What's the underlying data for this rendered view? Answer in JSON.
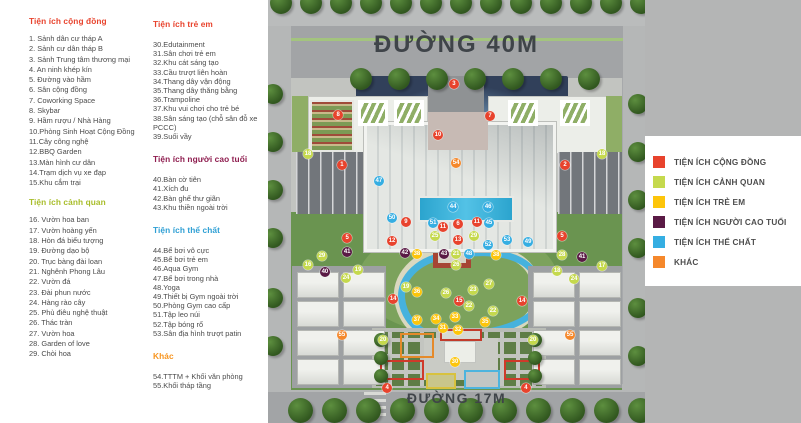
{
  "amenities": {
    "congdong": {
      "title": "Tiện ích cộng đồng",
      "color": "#e8432d",
      "items": [
        "1. Sảnh dân cư tháp A",
        "2. Sảnh cư dân tháp B",
        "3. Sảnh Trung tâm thương mại",
        "4. An ninh khép kín",
        "5. Đường vào hầm",
        "6. Sân cộng đồng",
        "7. Coworking Space",
        "8. Skybar",
        "9. Hầm rượu / Nhà Hàng",
        "10.Phòng Sinh Hoạt Cộng Đồng",
        "11.Cây công nghệ",
        "12.BBQ Garden",
        "13.Màn hình cư dân",
        "14.Trạm dịch vụ xe đạp",
        "15.Khu cắm trại"
      ]
    },
    "canhquan": {
      "title": "Tiện ích cảnh quan",
      "color": "#a8bd2a",
      "items": [
        "16. Vườn hoa ban",
        "17. Vườn hoàng yến",
        "18. Hòn đá biểu tượng",
        "19. Đường dạo bộ",
        "20. Trục bàng đài loan",
        "21. Nghênh Phong Lâu",
        "22. Vườn đá",
        "23. Đài phun nước",
        "24. Hàng rào cây",
        "25. Phù điêu nghệ thuật",
        "26. Thác tràn",
        "27. Vườn hoa",
        "28. Garden of love",
        "29. Chòi hoa"
      ]
    },
    "treem": {
      "title": "Tiện ích trẻ em",
      "color": "#e8432d",
      "items": [
        "30.Edutainment",
        "31.Sân chơi trẻ em",
        "32.Khu cát sáng tạo",
        "33.Cầu trượt liên hoàn",
        "34.Thang dây vận động",
        "35.Thang dây thăng bằng",
        "36.Trampoline",
        "37.Khu vui chơi cho trẻ bé",
        "38.Sân sáng tạo (chỗ sân đỗ xe PCCC)",
        "39.Suối vầy"
      ]
    },
    "caotuoi": {
      "title": "Tiện ích người cao tuổi",
      "color": "#8e1c4e",
      "items": [
        "40.Bàn cờ tiên",
        "41.Xích đu",
        "42.Bàn ghế thư giãn",
        "43.Khu thiền ngoài trời"
      ]
    },
    "thechat": {
      "title": "Tiện ích thể chất",
      "color": "#2e9fd4",
      "items": [
        "44.Bể bơi vô cực",
        "45.Bể bơi trẻ em",
        "46.Aqua Gym",
        "47.Bể bơi trong nhà",
        "48.Yoga",
        "49.Thiết bị Gym ngoài trời",
        "50.Phòng Gym cao cấp",
        "51.Tập leo núi",
        "52.Tập bóng rổ",
        "53.Sân địa hình trượt patin"
      ]
    },
    "khac": {
      "title": "Khác",
      "color": "#f7941e",
      "items": [
        "54.TTTM + Khối văn phòng",
        "55.Khối tháp tầng"
      ]
    }
  },
  "map": {
    "road_top_label": "ĐƯỜNG 40M",
    "road_bottom_label": "ĐƯỜNG 17M",
    "markers": [
      {
        "n": 3,
        "cat": "congdong",
        "x": 49.3,
        "y": 19.9
      },
      {
        "n": 8,
        "cat": "congdong",
        "x": 18.6,
        "y": 27.2
      },
      {
        "n": 7,
        "cat": "congdong",
        "x": 58.9,
        "y": 27.4
      },
      {
        "n": 10,
        "cat": "congdong",
        "x": 45.1,
        "y": 31.9
      },
      {
        "n": 54,
        "cat": "khac",
        "x": 49.9,
        "y": 38.5
      },
      {
        "n": 1,
        "cat": "congdong",
        "x": 19.6,
        "y": 39.0
      },
      {
        "n": 2,
        "cat": "congdong",
        "x": 78.8,
        "y": 39.0
      },
      {
        "n": 18,
        "cat": "canhquan",
        "x": 10.6,
        "y": 36.4
      },
      {
        "n": 18,
        "cat": "canhquan",
        "x": 88.6,
        "y": 36.4
      },
      {
        "n": 47,
        "cat": "thechat",
        "x": 29.4,
        "y": 42.8
      },
      {
        "n": 44,
        "cat": "thechat",
        "x": 49.1,
        "y": 48.9
      },
      {
        "n": 46,
        "cat": "thechat",
        "x": 58.4,
        "y": 48.9
      },
      {
        "n": 50,
        "cat": "thechat",
        "x": 32.9,
        "y": 51.5
      },
      {
        "n": 9,
        "cat": "congdong",
        "x": 36.6,
        "y": 52.5
      },
      {
        "n": 51,
        "cat": "thechat",
        "x": 43.8,
        "y": 52.7
      },
      {
        "n": 11,
        "cat": "congdong",
        "x": 46.4,
        "y": 53.7
      },
      {
        "n": 6,
        "cat": "congdong",
        "x": 50.4,
        "y": 53.0
      },
      {
        "n": 11,
        "cat": "congdong",
        "x": 55.4,
        "y": 52.5
      },
      {
        "n": 45,
        "cat": "thechat",
        "x": 58.6,
        "y": 52.7
      },
      {
        "n": 5,
        "cat": "congdong",
        "x": 21.0,
        "y": 56.3
      },
      {
        "n": 25,
        "cat": "canhquan",
        "x": 44.3,
        "y": 55.8
      },
      {
        "n": 13,
        "cat": "congdong",
        "x": 50.4,
        "y": 56.7
      },
      {
        "n": 29,
        "cat": "canhquan",
        "x": 54.6,
        "y": 55.8
      },
      {
        "n": 52,
        "cat": "thechat",
        "x": 58.4,
        "y": 57.9
      },
      {
        "n": 53,
        "cat": "thechat",
        "x": 63.4,
        "y": 56.7
      },
      {
        "n": 49,
        "cat": "thechat",
        "x": 69.0,
        "y": 57.2
      },
      {
        "n": 5,
        "cat": "congdong",
        "x": 78.0,
        "y": 55.8
      },
      {
        "n": 41,
        "cat": "caotuoi",
        "x": 21.0,
        "y": 59.6
      },
      {
        "n": 12,
        "cat": "congdong",
        "x": 32.9,
        "y": 57.0
      },
      {
        "n": 42,
        "cat": "caotuoi",
        "x": 36.3,
        "y": 59.8
      },
      {
        "n": 38,
        "cat": "treem",
        "x": 39.5,
        "y": 60.0
      },
      {
        "n": 43,
        "cat": "caotuoi",
        "x": 46.7,
        "y": 60.0
      },
      {
        "n": 21,
        "cat": "canhquan",
        "x": 49.9,
        "y": 60.0
      },
      {
        "n": 48,
        "cat": "thechat",
        "x": 53.3,
        "y": 60.0
      },
      {
        "n": 38,
        "cat": "treem",
        "x": 60.5,
        "y": 60.3
      },
      {
        "n": 28,
        "cat": "canhquan",
        "x": 78.0,
        "y": 60.3
      },
      {
        "n": 41,
        "cat": "caotuoi",
        "x": 83.3,
        "y": 60.8
      },
      {
        "n": 29,
        "cat": "canhquan",
        "x": 14.3,
        "y": 60.5
      },
      {
        "n": 16,
        "cat": "canhquan",
        "x": 10.6,
        "y": 62.6
      },
      {
        "n": 17,
        "cat": "canhquan",
        "x": 88.6,
        "y": 62.9
      },
      {
        "n": 40,
        "cat": "caotuoi",
        "x": 15.1,
        "y": 64.3
      },
      {
        "n": 19,
        "cat": "canhquan",
        "x": 23.9,
        "y": 63.8
      },
      {
        "n": 24,
        "cat": "canhquan",
        "x": 20.7,
        "y": 65.7
      },
      {
        "n": 18,
        "cat": "canhquan",
        "x": 76.7,
        "y": 64.1
      },
      {
        "n": 24,
        "cat": "canhquan",
        "x": 81.2,
        "y": 66.0
      },
      {
        "n": 26,
        "cat": "canhquan",
        "x": 49.9,
        "y": 62.6
      },
      {
        "n": 27,
        "cat": "canhquan",
        "x": 58.6,
        "y": 67.1
      },
      {
        "n": 23,
        "cat": "canhquan",
        "x": 54.4,
        "y": 68.6
      },
      {
        "n": 19,
        "cat": "canhquan",
        "x": 36.6,
        "y": 67.8
      },
      {
        "n": 36,
        "cat": "treem",
        "x": 39.5,
        "y": 69.0
      },
      {
        "n": 26,
        "cat": "canhquan",
        "x": 47.2,
        "y": 69.3
      },
      {
        "n": 14,
        "cat": "congdong",
        "x": 33.2,
        "y": 70.7
      },
      {
        "n": 15,
        "cat": "congdong",
        "x": 50.7,
        "y": 71.2
      },
      {
        "n": 22,
        "cat": "canhquan",
        "x": 53.3,
        "y": 72.3
      },
      {
        "n": 14,
        "cat": "congdong",
        "x": 67.4,
        "y": 71.2
      },
      {
        "n": 22,
        "cat": "canhquan",
        "x": 59.7,
        "y": 73.5
      },
      {
        "n": 37,
        "cat": "treem",
        "x": 39.5,
        "y": 75.7
      },
      {
        "n": 34,
        "cat": "treem",
        "x": 44.6,
        "y": 75.4
      },
      {
        "n": 33,
        "cat": "treem",
        "x": 49.6,
        "y": 74.9
      },
      {
        "n": 35,
        "cat": "treem",
        "x": 57.6,
        "y": 76.1
      },
      {
        "n": 31,
        "cat": "treem",
        "x": 46.4,
        "y": 77.5
      },
      {
        "n": 32,
        "cat": "treem",
        "x": 50.4,
        "y": 78.0
      },
      {
        "n": 55,
        "cat": "khac",
        "x": 19.6,
        "y": 79.2
      },
      {
        "n": 55,
        "cat": "khac",
        "x": 80.1,
        "y": 79.2
      },
      {
        "n": 20,
        "cat": "canhquan",
        "x": 30.5,
        "y": 80.4
      },
      {
        "n": 20,
        "cat": "canhquan",
        "x": 70.3,
        "y": 80.4
      },
      {
        "n": 30,
        "cat": "treem",
        "x": 49.6,
        "y": 85.6
      },
      {
        "n": 4,
        "cat": "congdong",
        "x": 31.6,
        "y": 91.7
      },
      {
        "n": 4,
        "cat": "congdong",
        "x": 68.4,
        "y": 91.7
      }
    ]
  },
  "legend": {
    "colors": {
      "congdong": "#e8432d",
      "canhquan": "#c5d94d",
      "treem": "#fdc50a",
      "caotuoi": "#5a1a45",
      "thechat": "#35aee2",
      "khac": "#f5882b"
    },
    "items": [
      {
        "cat": "congdong",
        "label": "TIỆN ÍCH CỘNG ĐỒNG"
      },
      {
        "cat": "canhquan",
        "label": "TIỆN ÍCH CẢNH QUAN"
      },
      {
        "cat": "treem",
        "label": "TIỆN ÍCH TRẺ EM"
      },
      {
        "cat": "caotuoi",
        "label": "TIỆN ÍCH NGƯỜI CAO TUỔI"
      },
      {
        "cat": "thechat",
        "label": "TIỆN ÍCH THỂ CHẤT"
      },
      {
        "cat": "khac",
        "label": "KHÁC"
      }
    ]
  }
}
